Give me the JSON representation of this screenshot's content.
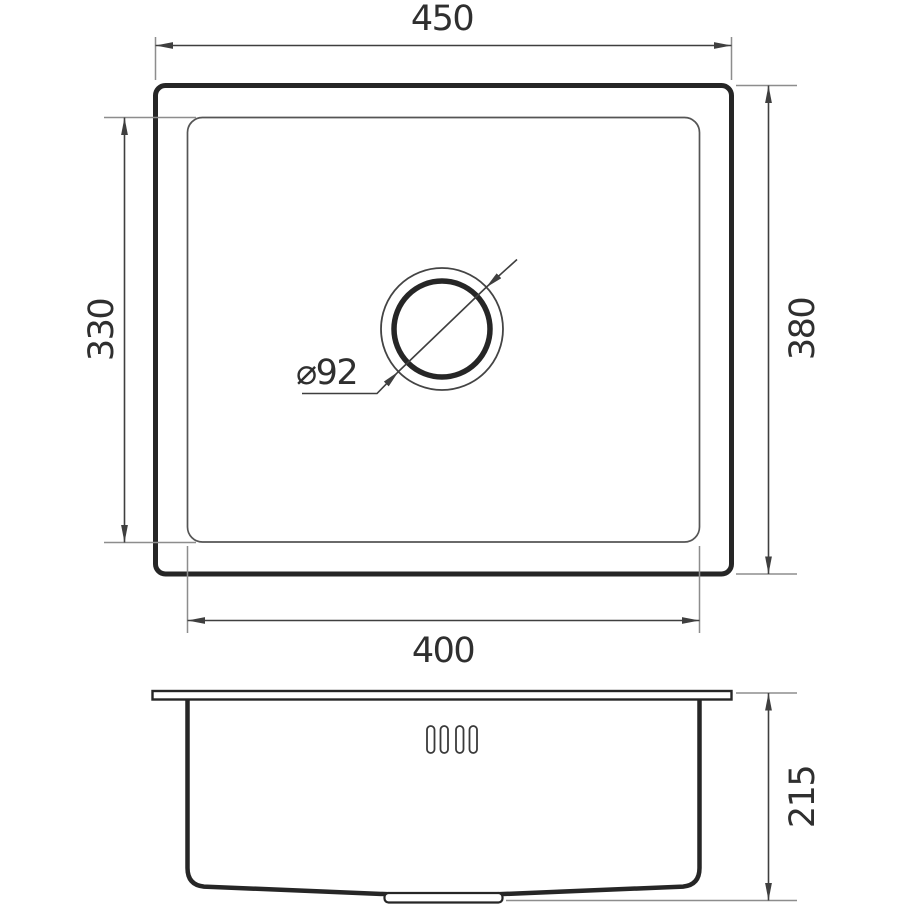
{
  "drawing": {
    "type": "technical-dimension-drawing",
    "views": {
      "top_view": {
        "outer_width_label": "450",
        "outer_depth_label": "380",
        "inner_width_label": "400",
        "inner_depth_label": "330",
        "drain_diameter_label": "⌀92"
      },
      "side_view": {
        "height_label": "215"
      }
    },
    "colors": {
      "background": "#ffffff",
      "heavy_line": "#262626",
      "thin_line": "#4a4a4a",
      "dimension_line": "#3f3f3f",
      "extension_line": "#8d8d8d",
      "text": "#2f2f2f"
    }
  }
}
